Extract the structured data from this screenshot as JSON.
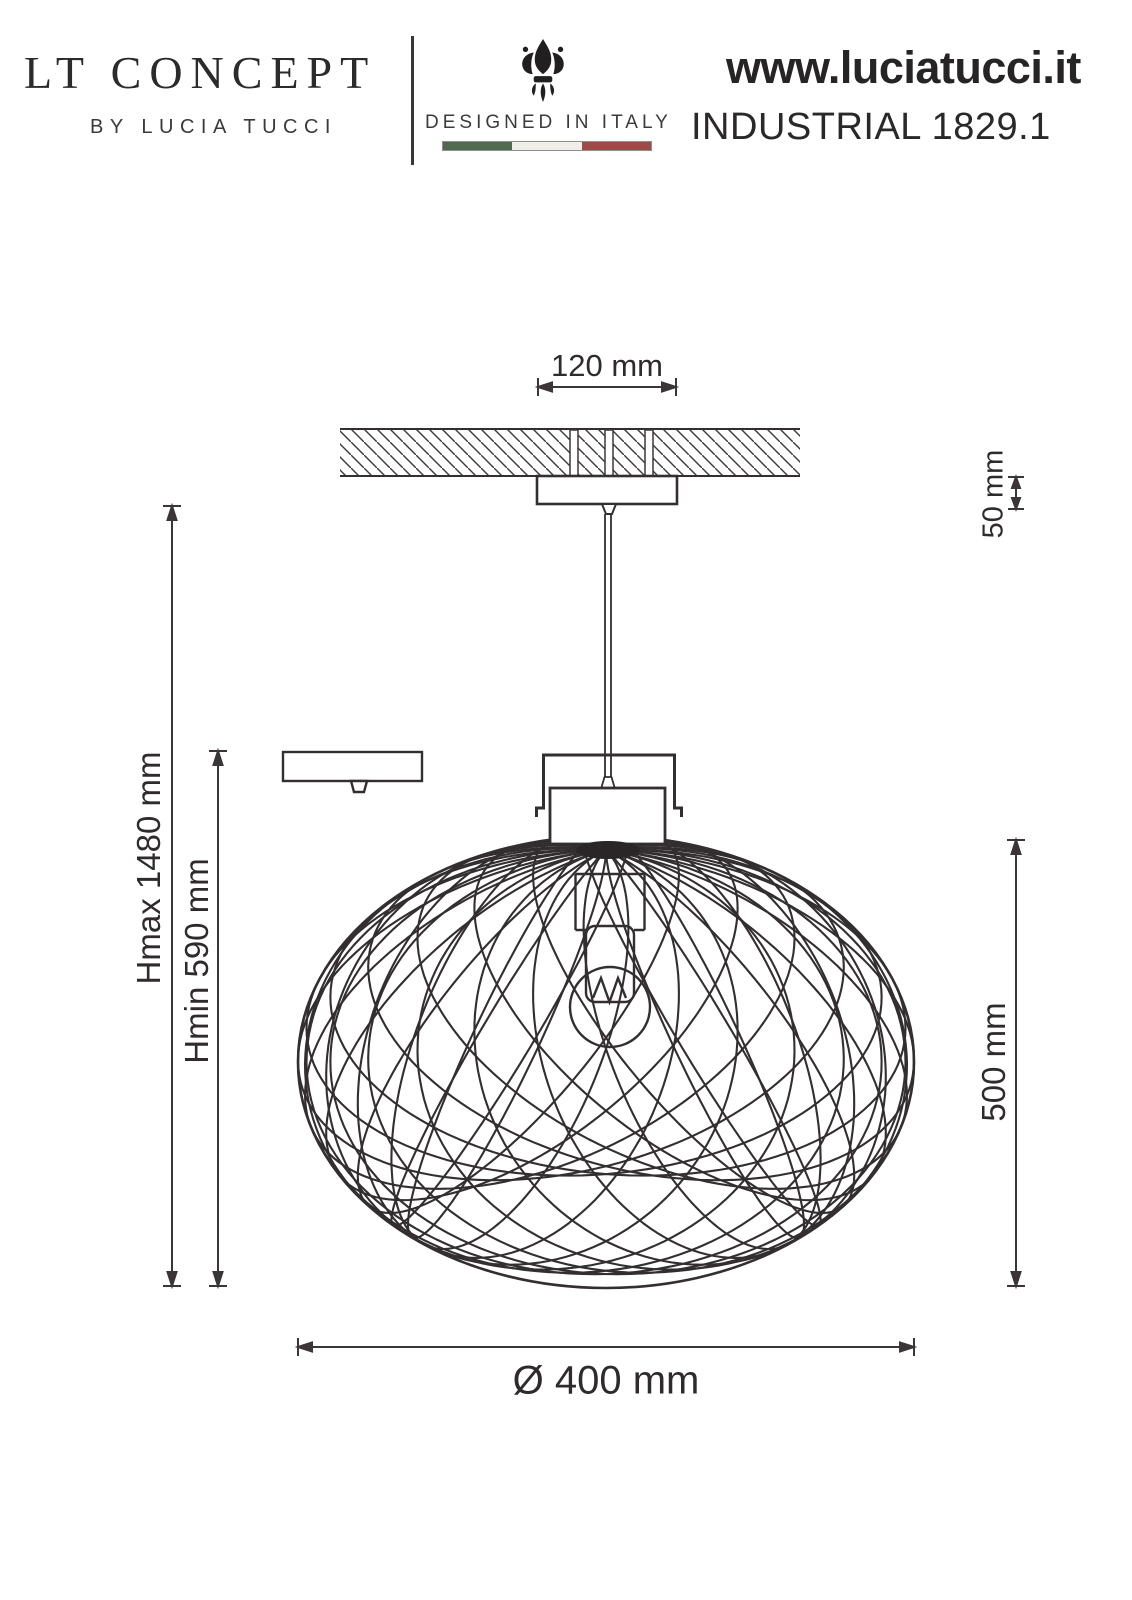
{
  "brand": {
    "logo_title": "LT CONCEPT",
    "logo_subtitle": "BY LUCIA TUCCI",
    "designed_in": "DESIGNED IN ITALY",
    "website": "www.luciatucci.it"
  },
  "product": {
    "name": "INDUSTRIAL 1829.1"
  },
  "flag_colors": {
    "green": "#50694f",
    "white": "#efeeea",
    "red": "#9c4b49"
  },
  "drawing": {
    "ink_color": "#332e2f",
    "dimensions": {
      "canopy_width": "120 mm",
      "canopy_height": "50 mm",
      "max_height": "Hmax 1480 mm",
      "min_height": "Hmin 590 mm",
      "shade_height": "500 mm",
      "shade_diameter": "Ø 400 mm"
    }
  }
}
